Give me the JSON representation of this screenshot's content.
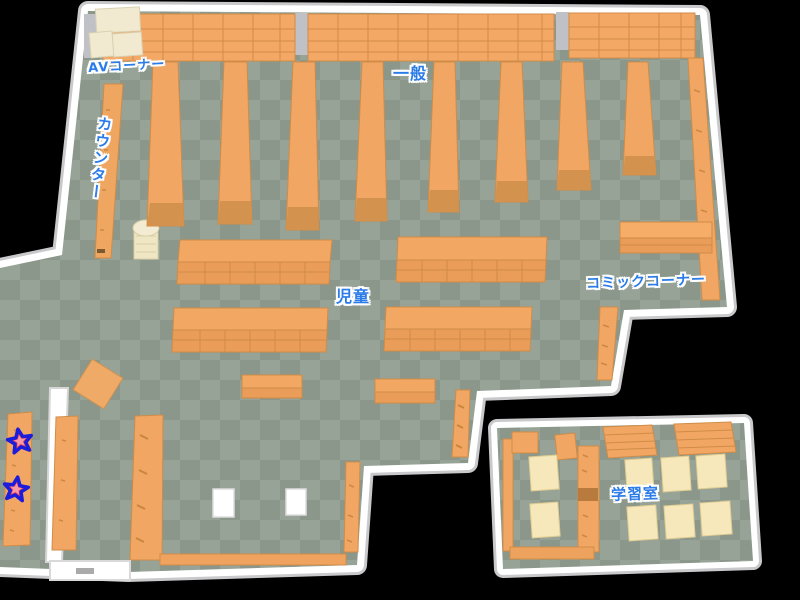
{
  "map": {
    "name": "library-floor-map",
    "areas": [
      {
        "id": "av-corner",
        "label": "AVコーナー"
      },
      {
        "id": "general",
        "label": "一般"
      },
      {
        "id": "counter",
        "label": "カウンター"
      },
      {
        "id": "children",
        "label": "児童"
      },
      {
        "id": "comic-corner",
        "label": "コミックコーナー"
      },
      {
        "id": "study-room",
        "label": "学習室"
      }
    ],
    "markers": [
      {
        "id": "star-1",
        "type": "star"
      },
      {
        "id": "star-2",
        "type": "star"
      }
    ],
    "colors": {
      "background": "#000000",
      "floor_light": "#96a396",
      "floor_dark": "#8a978a",
      "wall_white": "#ffffff",
      "wall_shadow": "#c9c9cb",
      "shelf_orange": "#f1a763",
      "shelf_edge": "#d08c48",
      "shelf_base": "#d3924e",
      "table_cream": "#f6e8ba",
      "av_cream": "#f2ead0",
      "label_blue": "#2b7ce8",
      "star_red": "#e8404f",
      "star_outline": "#1c1cdd"
    }
  }
}
